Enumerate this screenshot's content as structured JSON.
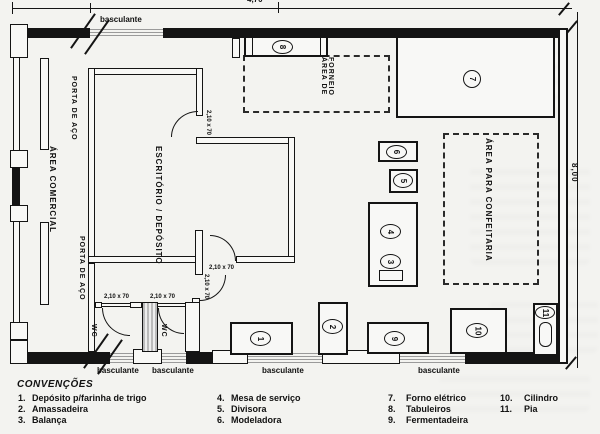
{
  "plan": {
    "dimensions": {
      "top": "4,70",
      "right": "8,00"
    },
    "window_label": "basculante",
    "door_label": "2,10 x 70",
    "rooms": {
      "area_comercial": "ÁREA COMERCIAL",
      "porta_de_aco": "PORTA DE AÇO",
      "escritorio_deposito": "ESCRITÓRIO / DEPÓSITO",
      "area_de_forneio_line1": "ÁREA DE",
      "area_de_forneio_line2": "FORNEIO",
      "area_para_confeitaria": "ÁREA PARA CONFEITARIA",
      "wc": "WC"
    },
    "equipment_numbers": [
      "1",
      "2",
      "3",
      "4",
      "5",
      "6",
      "7",
      "8",
      "9",
      "10",
      "11"
    ]
  },
  "legend": {
    "title": "CONVENÇÕES",
    "entries": [
      {
        "num": "1.",
        "label": "Depósito p/farinha de trigo"
      },
      {
        "num": "2.",
        "label": "Amassadeira"
      },
      {
        "num": "3.",
        "label": "Balança"
      },
      {
        "num": "4.",
        "label": "Mesa de serviço"
      },
      {
        "num": "5.",
        "label": "Divisora"
      },
      {
        "num": "6.",
        "label": "Modeladora"
      },
      {
        "num": "7.",
        "label": "Forno elétrico"
      },
      {
        "num": "8.",
        "label": "Tabuleiros"
      },
      {
        "num": "9.",
        "label": "Fermentadeira"
      },
      {
        "num": "10.",
        "label": "Cilindro"
      },
      {
        "num": "11.",
        "label": "Pia"
      }
    ]
  }
}
